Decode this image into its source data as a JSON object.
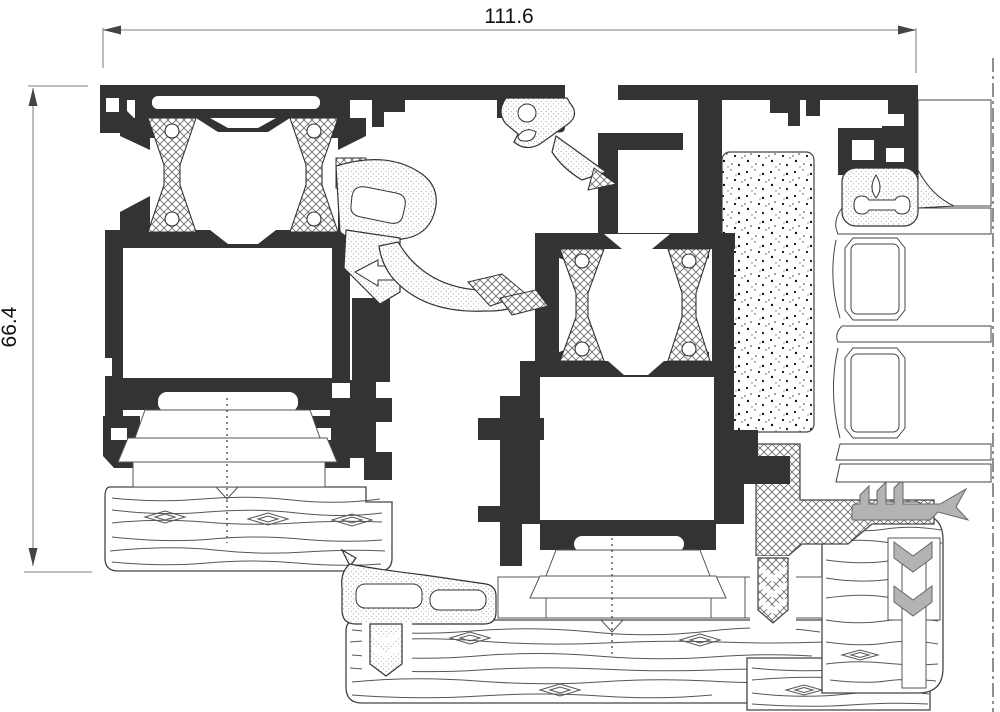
{
  "drawing": {
    "type": "technical-cross-section",
    "subject": "aluminium window sill profile section",
    "dimensions": {
      "width_label": "111.6",
      "height_label": "66.4"
    },
    "colors": {
      "profile_black": "#333333",
      "dim_line_gray": "#999999",
      "arrow_gray": "#444444",
      "text_color": "#111111",
      "outline_gray": "#4a4a4a",
      "wood_line": "#555555",
      "seal_gray": "#b3b3b3",
      "hatch_line": "#666666"
    }
  }
}
